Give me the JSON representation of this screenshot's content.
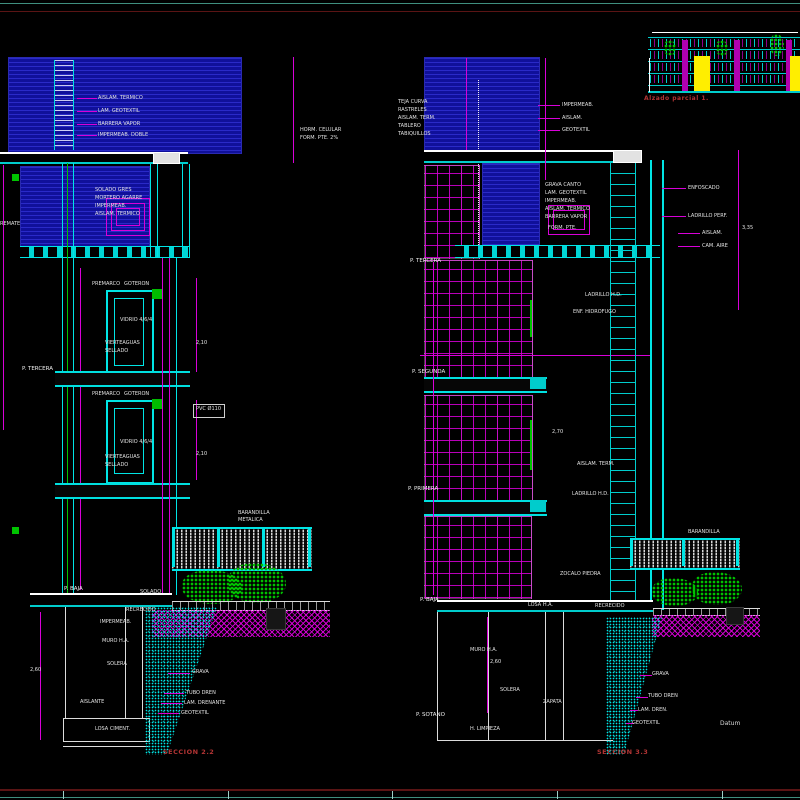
{
  "drawing": {
    "left_section": {
      "caption": "SECCION 2.2"
    },
    "right_section": {
      "caption": "SECCION 3.3",
      "datum_label": "Datum"
    },
    "elevation": {
      "caption": "Alzado parcial 1."
    }
  },
  "colors": {
    "background": "#000000",
    "cyan": "#00e5e5",
    "magenta": "#d800d8",
    "blue_hatch": "#1212a8",
    "green": "#00c400",
    "white": "#e8e8e8",
    "red_label": "#b23434",
    "border_teal": "#3f8f7f",
    "border_red": "#5a1414",
    "yellow": "#ffee00"
  },
  "labels": [
    {
      "x": 98,
      "y": 96,
      "t": "AISLAM. TERMICO"
    },
    {
      "x": 98,
      "y": 109,
      "t": "LAM. GEOTEXTIL"
    },
    {
      "x": 98,
      "y": 122,
      "t": "BARRERA VAPOR"
    },
    {
      "x": 98,
      "y": 133,
      "t": "IMPERMEAB. DOBLE"
    },
    {
      "x": 300,
      "y": 128,
      "t": "HORM. CELULAR"
    },
    {
      "x": 300,
      "y": 136,
      "t": "FORM. PTE. 2%"
    },
    {
      "x": 95,
      "y": 188,
      "t": "SOLADO GRES"
    },
    {
      "x": 95,
      "y": 196,
      "t": "MORTERO AGARRE"
    },
    {
      "x": 95,
      "y": 204,
      "t": "IMPERMEAB."
    },
    {
      "x": 95,
      "y": 212,
      "t": "AISLAM. TERMICO"
    },
    {
      "x": 0,
      "y": 222,
      "t": "REMATE"
    },
    {
      "x": 92,
      "y": 282,
      "t": "PREMARCO"
    },
    {
      "x": 124,
      "y": 282,
      "t": "GOTERON"
    },
    {
      "x": 120,
      "y": 318,
      "t": "VIDRIO 4/6/4"
    },
    {
      "x": 105,
      "y": 341,
      "t": "VIERTEAGUAS"
    },
    {
      "x": 105,
      "y": 349,
      "t": "SELLADO"
    },
    {
      "x": 196,
      "y": 341,
      "t": "2,10"
    },
    {
      "x": 92,
      "y": 392,
      "t": "PREMARCO"
    },
    {
      "x": 124,
      "y": 392,
      "t": "GOTERON"
    },
    {
      "x": 120,
      "y": 440,
      "t": "VIDRIO 4/6/4"
    },
    {
      "x": 105,
      "y": 455,
      "t": "VIERTEAGUAS"
    },
    {
      "x": 105,
      "y": 463,
      "t": "SELLADO"
    },
    {
      "x": 196,
      "y": 452,
      "t": "2,10"
    },
    {
      "x": 196,
      "y": 407,
      "t": "PVC Ø110"
    },
    {
      "x": 22,
      "y": 366,
      "t": "P. TERCERA",
      "c": "f"
    },
    {
      "x": 64,
      "y": 586,
      "t": "P. BAJA",
      "c": "f"
    },
    {
      "x": 238,
      "y": 511,
      "t": "BARANDILLA"
    },
    {
      "x": 238,
      "y": 518,
      "t": "METALICA"
    },
    {
      "x": 140,
      "y": 590,
      "t": "SOLADO"
    },
    {
      "x": 126,
      "y": 608,
      "t": "RECRECIDO"
    },
    {
      "x": 100,
      "y": 620,
      "t": "IMPERMEAB."
    },
    {
      "x": 102,
      "y": 639,
      "t": "MURO H.A."
    },
    {
      "x": 107,
      "y": 662,
      "t": "SOLERA"
    },
    {
      "x": 80,
      "y": 700,
      "t": "AISLANTE"
    },
    {
      "x": 95,
      "y": 727,
      "t": "LOSA CIMENT."
    },
    {
      "x": 30,
      "y": 668,
      "t": "2,60"
    },
    {
      "x": 192,
      "y": 670,
      "t": "GRAVA"
    },
    {
      "x": 186,
      "y": 691,
      "t": "TUBO DREN"
    },
    {
      "x": 184,
      "y": 701,
      "t": "LAM. DRENANTE"
    },
    {
      "x": 181,
      "y": 711,
      "t": "GEOTEXTIL"
    },
    {
      "x": 398,
      "y": 100,
      "t": "TEJA CURVA"
    },
    {
      "x": 398,
      "y": 108,
      "t": "RASTRELES"
    },
    {
      "x": 398,
      "y": 116,
      "t": "AISLAM. TERM."
    },
    {
      "x": 398,
      "y": 124,
      "t": "TABLERO"
    },
    {
      "x": 398,
      "y": 132,
      "t": "TABIQUILLOS"
    },
    {
      "x": 562,
      "y": 103,
      "t": "IMPERMEAB."
    },
    {
      "x": 562,
      "y": 116,
      "t": "AISLAM."
    },
    {
      "x": 562,
      "y": 128,
      "t": "GEOTEXTIL"
    },
    {
      "x": 545,
      "y": 183,
      "t": "GRAVA CANTO"
    },
    {
      "x": 545,
      "y": 191,
      "t": "LAM. GEOTEXTIL"
    },
    {
      "x": 545,
      "y": 199,
      "t": "IMPERMEAB."
    },
    {
      "x": 545,
      "y": 207,
      "t": "AISLAM. TERMICO"
    },
    {
      "x": 545,
      "y": 215,
      "t": "BARRERA VAPOR"
    },
    {
      "x": 548,
      "y": 226,
      "t": "FORM. PTE."
    },
    {
      "x": 688,
      "y": 186,
      "t": "ENFOSCADO"
    },
    {
      "x": 688,
      "y": 214,
      "t": "LADRILLO PERF."
    },
    {
      "x": 702,
      "y": 231,
      "t": "AISLAM."
    },
    {
      "x": 702,
      "y": 244,
      "t": "CAM. AIRE"
    },
    {
      "x": 742,
      "y": 226,
      "t": "3,35"
    },
    {
      "x": 585,
      "y": 293,
      "t": "LADRILLO H.D."
    },
    {
      "x": 573,
      "y": 310,
      "t": "ENF. HIDROFUGO"
    },
    {
      "x": 552,
      "y": 430,
      "t": "2,70"
    },
    {
      "x": 577,
      "y": 462,
      "t": "AISLAM. TERM."
    },
    {
      "x": 572,
      "y": 492,
      "t": "LADRILLO H.D."
    },
    {
      "x": 560,
      "y": 572,
      "t": "ZOCALO PIEDRA"
    },
    {
      "x": 410,
      "y": 258,
      "t": "P. TERCERA",
      "c": "f"
    },
    {
      "x": 412,
      "y": 369,
      "t": "P. SEGUNDA",
      "c": "f"
    },
    {
      "x": 408,
      "y": 486,
      "t": "P. PRIMERA",
      "c": "f"
    },
    {
      "x": 420,
      "y": 597,
      "t": "P. BAJA",
      "c": "f"
    },
    {
      "x": 416,
      "y": 712,
      "t": "P. SOTANO",
      "c": "f"
    },
    {
      "x": 528,
      "y": 603,
      "t": "LOSA H.A."
    },
    {
      "x": 595,
      "y": 604,
      "t": "RECRECIDO"
    },
    {
      "x": 470,
      "y": 648,
      "t": "MURO H.A."
    },
    {
      "x": 500,
      "y": 688,
      "t": "SOLERA"
    },
    {
      "x": 543,
      "y": 700,
      "t": "ZAPATA"
    },
    {
      "x": 470,
      "y": 727,
      "t": "H. LIMPIEZA"
    },
    {
      "x": 688,
      "y": 530,
      "t": "BARANDILLA"
    },
    {
      "x": 652,
      "y": 672,
      "t": "GRAVA"
    },
    {
      "x": 648,
      "y": 694,
      "t": "TUBO DREN"
    },
    {
      "x": 638,
      "y": 708,
      "t": "LAM. DREN."
    },
    {
      "x": 632,
      "y": 721,
      "t": "GEOTEXTIL"
    },
    {
      "x": 490,
      "y": 660,
      "t": "2,60"
    }
  ]
}
